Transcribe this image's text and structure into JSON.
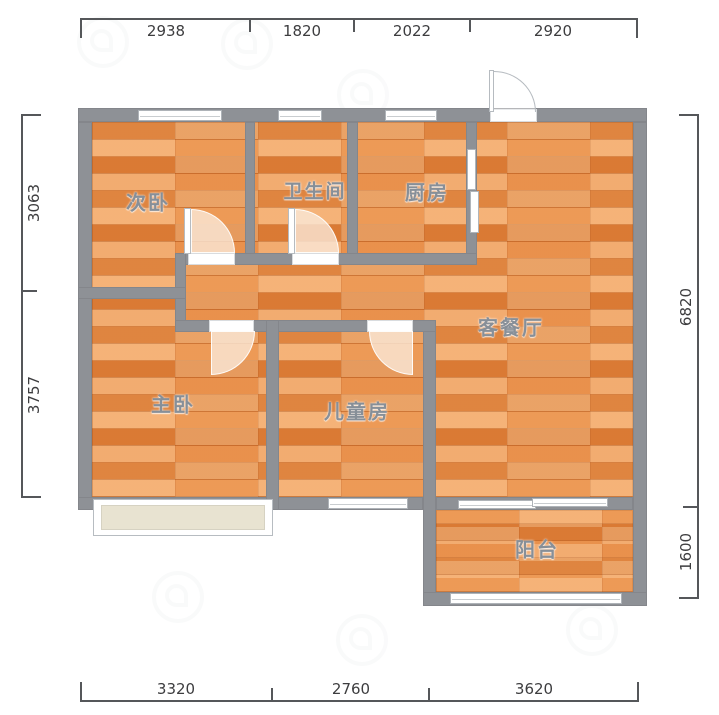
{
  "rooms": {
    "ciwo": "次卧",
    "weishengjian": "卫生间",
    "chufang": "厨房",
    "kecanting": "客餐厅",
    "zhuwo": "主卧",
    "ertongfang": "儿童房",
    "yangtai": "阳台"
  },
  "dims": {
    "top": [
      "2938",
      "1820",
      "2022",
      "2920"
    ],
    "bottom": [
      "3320",
      "2760",
      "3620"
    ],
    "left": [
      "3063",
      "3757"
    ],
    "right": [
      "6820",
      "1600"
    ]
  },
  "colors": {
    "wall": "#8e9196",
    "floor_light": "#f09f5c",
    "floor_dark": "#db7c37",
    "window": "#ffffff",
    "bay_fill": "#e8e3d1",
    "dim_line": "#55575a",
    "dim_text": "#3d3d3f",
    "label_text": "#878f98"
  }
}
